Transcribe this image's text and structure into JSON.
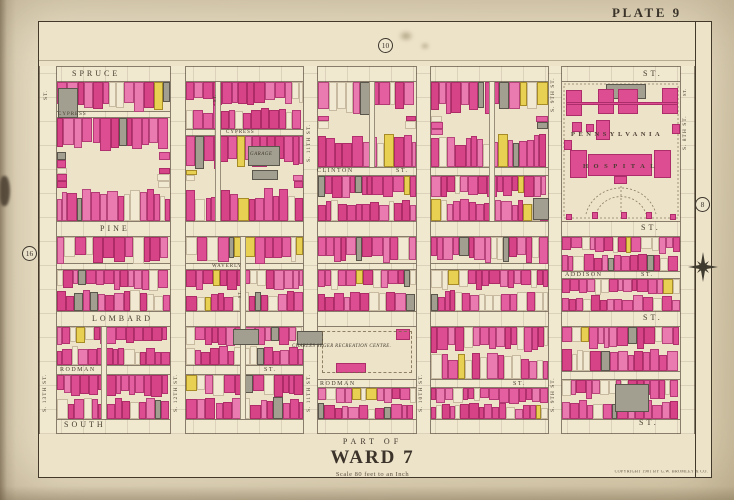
{
  "page": {
    "plate_label": "PLATE 9",
    "part_of": "PART OF",
    "ward_title": "WARD 7",
    "scale_note": "Scale 80 feet to an Inch",
    "copyright": "COPYRIGHT 1901 BY G.W. BROMLEY & CO."
  },
  "plate_refs": [
    {
      "label": "10",
      "x": 378,
      "y": 38
    },
    {
      "label": "16",
      "x": 22,
      "y": 246
    },
    {
      "label": "8",
      "x": 695,
      "y": 197
    }
  ],
  "colors": {
    "pinks": [
      "#e35f9f",
      "#dd4d92",
      "#e97bb0",
      "#d64386"
    ],
    "pink_border": "rgba(140,25,80,0.55)",
    "gray": "#a29e90",
    "gray_border": "rgba(60,55,45,0.7)",
    "yellow": "#e8d152",
    "yellow_border": "rgba(140,110,20,0.7)",
    "cream_lot": "#f2e9d2",
    "cream_border": "rgba(120,100,70,0.35)"
  },
  "streets": {
    "bands": [
      {
        "name": "spruce-st",
        "dir": "h",
        "x": 39,
        "y": 66,
        "w": 656,
        "h": 16
      },
      {
        "name": "cypress-st-w",
        "dir": "h",
        "x": 39,
        "y": 111,
        "w": 131,
        "h": 7
      },
      {
        "name": "cypress-st-e",
        "dir": "h",
        "x": 170,
        "y": 129,
        "w": 133,
        "h": 7
      },
      {
        "name": "clinton-st",
        "dir": "h",
        "x": 303,
        "y": 167,
        "w": 245,
        "h": 9
      },
      {
        "name": "pine-st",
        "dir": "h",
        "x": 39,
        "y": 221,
        "w": 656,
        "h": 16
      },
      {
        "name": "waverly-st",
        "dir": "h",
        "x": 39,
        "y": 263,
        "w": 509,
        "h": 7
      },
      {
        "name": "addison-st",
        "dir": "h",
        "x": 548,
        "y": 271,
        "w": 147,
        "h": 8
      },
      {
        "name": "lombard-st",
        "dir": "h",
        "x": 39,
        "y": 311,
        "w": 656,
        "h": 16
      },
      {
        "name": "rodman-st-w",
        "dir": "h",
        "x": 39,
        "y": 365,
        "w": 264,
        "h": 10
      },
      {
        "name": "rodman-st-c",
        "dir": "h",
        "x": 303,
        "y": 379,
        "w": 245,
        "h": 9
      },
      {
        "name": "rodman-st-e",
        "dir": "h",
        "x": 548,
        "y": 371,
        "w": 147,
        "h": 9
      },
      {
        "name": "south-st",
        "dir": "h",
        "x": 39,
        "y": 419,
        "w": 656,
        "h": 15
      },
      {
        "name": "s-13th-st",
        "dir": "v",
        "x": 39,
        "y": 66,
        "w": 18,
        "h": 368
      },
      {
        "name": "s-12th-st",
        "dir": "v",
        "x": 170,
        "y": 66,
        "w": 16,
        "h": 368
      },
      {
        "name": "s-11th-st",
        "dir": "v",
        "x": 303,
        "y": 66,
        "w": 15,
        "h": 368
      },
      {
        "name": "s-10th-st",
        "dir": "v",
        "x": 416,
        "y": 66,
        "w": 15,
        "h": 368
      },
      {
        "name": "s-9th-st",
        "dir": "v",
        "x": 548,
        "y": 66,
        "w": 14,
        "h": 368
      },
      {
        "name": "s-8th-st",
        "dir": "v",
        "x": 680,
        "y": 66,
        "w": 15,
        "h": 368
      }
    ],
    "labels": [
      {
        "name": "spruce",
        "cls": "major",
        "x": 72,
        "y": 70,
        "text": "SPRUCE"
      },
      {
        "name": "spruce-st",
        "cls": "major",
        "x": 643,
        "y": 70,
        "text": "ST."
      },
      {
        "name": "cypress-w",
        "cls": "tiny",
        "x": 58,
        "y": 111.5,
        "text": "CYPRESS"
      },
      {
        "name": "cypress-e",
        "cls": "tiny",
        "x": 226,
        "y": 129.5,
        "text": "CYPRESS"
      },
      {
        "name": "clinton",
        "cls": "minor",
        "x": 317,
        "y": 168,
        "text": "CLINTON"
      },
      {
        "name": "clinton-st",
        "cls": "minor",
        "x": 396,
        "y": 168,
        "text": "ST."
      },
      {
        "name": "pine",
        "cls": "major",
        "x": 100,
        "y": 225,
        "text": "PINE"
      },
      {
        "name": "pine-st",
        "cls": "major",
        "x": 641,
        "y": 224,
        "text": "ST."
      },
      {
        "name": "waverly",
        "cls": "tiny",
        "x": 212,
        "y": 263.5,
        "text": "WAVERLY"
      },
      {
        "name": "addison",
        "cls": "minor",
        "x": 565,
        "y": 271.5,
        "text": "ADDISON"
      },
      {
        "name": "addison-st",
        "cls": "minor",
        "x": 641,
        "y": 271.5,
        "text": "ST."
      },
      {
        "name": "lombard",
        "cls": "major",
        "x": 92,
        "y": 315,
        "text": "LOMBARD"
      },
      {
        "name": "lombard-st",
        "cls": "major",
        "x": 643,
        "y": 314,
        "text": "ST."
      },
      {
        "name": "rodman-w",
        "cls": "minor",
        "x": 60,
        "y": 366.5,
        "text": "RODMAN"
      },
      {
        "name": "rodman-w-st",
        "cls": "minor",
        "x": 264,
        "y": 366.5,
        "text": "ST."
      },
      {
        "name": "rodman-c",
        "cls": "minor",
        "x": 320,
        "y": 381,
        "text": "RODMAN"
      },
      {
        "name": "rodman-c-st",
        "cls": "minor",
        "x": 513,
        "y": 380.5,
        "text": "ST."
      },
      {
        "name": "south",
        "cls": "major",
        "x": 64,
        "y": 421,
        "text": "SOUTH"
      },
      {
        "name": "south-st",
        "cls": "major",
        "x": 639,
        "y": 419,
        "text": "ST."
      },
      {
        "name": "s-13th",
        "cls": "vert",
        "x": 43,
        "y": 412,
        "text": "S. 13TH ST."
      },
      {
        "name": "s-12th",
        "cls": "vert",
        "x": 174,
        "y": 412,
        "text": "S. 12TH ST."
      },
      {
        "name": "s-11th-s",
        "cls": "vert",
        "x": 307,
        "y": 412,
        "text": "S. 11TH ST."
      },
      {
        "name": "s-10th-s",
        "cls": "vert",
        "x": 419,
        "y": 412,
        "text": "S. 10TH ST."
      },
      {
        "name": "s-9th-s",
        "cls": "vert",
        "x": 551,
        "y": 412,
        "text": "S. 9TH ST."
      },
      {
        "name": "s-11th-n",
        "cls": "vert",
        "x": 307,
        "y": 162,
        "text": "S. 11TH ST."
      },
      {
        "name": "s-9th-n",
        "cls": "vert",
        "x": 551,
        "y": 112,
        "text": "S. 9TH ST."
      },
      {
        "name": "s-8th",
        "cls": "vert",
        "x": 683,
        "y": 150,
        "text": "S. 8TH ST."
      },
      {
        "name": "st-corner-nw",
        "cls": "vert",
        "x": 44,
        "y": 100,
        "text": "ST."
      },
      {
        "name": "st-8th-n",
        "cls": "vtiny",
        "x": 683,
        "y": 96,
        "text": "ST."
      },
      {
        "name": "alley-st-1",
        "cls": "vtiny",
        "x": 213,
        "y": 102,
        "text": "ST."
      },
      {
        "name": "alley-st-2",
        "cls": "vtiny",
        "x": 238,
        "y": 298,
        "text": "ST."
      }
    ]
  },
  "alleys": [
    {
      "x": 215,
      "y": 82,
      "w": 6,
      "h": 139
    },
    {
      "x": 240,
      "y": 237,
      "w": 6,
      "h": 182
    },
    {
      "x": 369,
      "y": 82,
      "w": 6,
      "h": 85
    },
    {
      "x": 489,
      "y": 82,
      "w": 6,
      "h": 139
    },
    {
      "x": 101,
      "y": 327,
      "w": 6,
      "h": 92
    }
  ],
  "blocks": [
    {
      "x": 57,
      "y": 82,
      "w": 113,
      "h": 29
    },
    {
      "x": 186,
      "y": 82,
      "w": 117,
      "h": 47
    },
    {
      "x": 318,
      "y": 82,
      "w": 98,
      "h": 85
    },
    {
      "x": 431,
      "y": 82,
      "w": 117,
      "h": 85
    },
    {
      "x": 57,
      "y": 118,
      "w": 113,
      "h": 103
    },
    {
      "x": 186,
      "y": 136,
      "w": 117,
      "h": 85
    },
    {
      "x": 318,
      "y": 176,
      "w": 98,
      "h": 45
    },
    {
      "x": 431,
      "y": 176,
      "w": 117,
      "h": 45
    },
    {
      "x": 57,
      "y": 237,
      "w": 113,
      "h": 26
    },
    {
      "x": 186,
      "y": 237,
      "w": 117,
      "h": 26
    },
    {
      "x": 318,
      "y": 237,
      "w": 98,
      "h": 26
    },
    {
      "x": 431,
      "y": 237,
      "w": 117,
      "h": 26
    },
    {
      "x": 562,
      "y": 237,
      "w": 118,
      "h": 34
    },
    {
      "x": 57,
      "y": 270,
      "w": 113,
      "h": 41
    },
    {
      "x": 186,
      "y": 270,
      "w": 117,
      "h": 41
    },
    {
      "x": 318,
      "y": 270,
      "w": 98,
      "h": 41
    },
    {
      "x": 431,
      "y": 270,
      "w": 117,
      "h": 41
    },
    {
      "x": 562,
      "y": 279,
      "w": 118,
      "h": 32
    },
    {
      "x": 57,
      "y": 327,
      "w": 113,
      "h": 38
    },
    {
      "x": 186,
      "y": 327,
      "w": 117,
      "h": 38
    },
    {
      "x": 431,
      "y": 327,
      "w": 117,
      "h": 52
    },
    {
      "x": 562,
      "y": 327,
      "w": 118,
      "h": 44
    },
    {
      "x": 57,
      "y": 375,
      "w": 113,
      "h": 44
    },
    {
      "x": 186,
      "y": 375,
      "w": 117,
      "h": 44
    },
    {
      "x": 318,
      "y": 388,
      "w": 98,
      "h": 31
    },
    {
      "x": 431,
      "y": 388,
      "w": 117,
      "h": 31
    },
    {
      "x": 562,
      "y": 380,
      "w": 118,
      "h": 39
    }
  ],
  "special_buildings": [
    {
      "type": "gray",
      "x": 58,
      "y": 88,
      "w": 20,
      "h": 30
    },
    {
      "type": "gray",
      "x": 248,
      "y": 146,
      "w": 32,
      "h": 20
    },
    {
      "type": "gray",
      "x": 252,
      "y": 170,
      "w": 26,
      "h": 10
    },
    {
      "type": "gray",
      "x": 233,
      "y": 329,
      "w": 26,
      "h": 16
    },
    {
      "type": "gray",
      "x": 297,
      "y": 331,
      "w": 26,
      "h": 14
    },
    {
      "type": "gray",
      "x": 533,
      "y": 198,
      "w": 16,
      "h": 22
    },
    {
      "type": "gray",
      "x": 615,
      "y": 384,
      "w": 34,
      "h": 28
    },
    {
      "type": "pink",
      "x": 336,
      "y": 363,
      "w": 30,
      "h": 10
    },
    {
      "type": "pink",
      "x": 396,
      "y": 329,
      "w": 14,
      "h": 11
    }
  ],
  "landmark_labels": [
    {
      "name": "garage-label",
      "cls": "it5",
      "x": 250,
      "y": 152,
      "text": "GARAGE"
    }
  ],
  "hospital": {
    "x": 562,
    "y": 82,
    "w": 118,
    "h": 139,
    "line1": "PENNSYLVANIA",
    "line2": "HOSPITAL",
    "line1_pos": {
      "x": 9,
      "y": 50
    },
    "line2_pos": {
      "x": 21,
      "y": 82
    },
    "buildings": [
      {
        "type": "gray",
        "x": 44,
        "y": 2,
        "w": 40,
        "h": 15
      },
      {
        "type": "pink",
        "x": 4,
        "y": 8,
        "w": 16,
        "h": 26
      },
      {
        "type": "pink",
        "x": 36,
        "y": 7,
        "w": 16,
        "h": 25
      },
      {
        "type": "pink",
        "x": 56,
        "y": 7,
        "w": 20,
        "h": 25
      },
      {
        "type": "pink",
        "x": 100,
        "y": 6,
        "w": 16,
        "h": 26
      },
      {
        "type": "pink",
        "x": 4,
        "y": 20,
        "w": 112,
        "h": 3
      },
      {
        "type": "pink",
        "x": 10,
        "y": 40,
        "w": 10,
        "h": 10
      },
      {
        "type": "pink",
        "x": 24,
        "y": 42,
        "w": 8,
        "h": 8
      },
      {
        "type": "pink",
        "x": 34,
        "y": 38,
        "w": 14,
        "h": 20
      },
      {
        "type": "pink",
        "x": 110,
        "y": 42,
        "w": 8,
        "h": 10
      },
      {
        "type": "pink",
        "x": 2,
        "y": 58,
        "w": 8,
        "h": 10
      },
      {
        "type": "pink",
        "x": 8,
        "y": 68,
        "w": 17,
        "h": 28
      },
      {
        "type": "pink",
        "x": 92,
        "y": 68,
        "w": 17,
        "h": 28
      },
      {
        "type": "pink",
        "x": 26,
        "y": 72,
        "w": 64,
        "h": 22
      },
      {
        "type": "pink",
        "x": 52,
        "y": 94,
        "w": 13,
        "h": 8
      },
      {
        "type": "pink",
        "x": 30,
        "y": 130,
        "w": 6,
        "h": 7
      },
      {
        "type": "pink",
        "x": 59,
        "y": 130,
        "w": 6,
        "h": 7
      },
      {
        "type": "pink",
        "x": 84,
        "y": 130,
        "w": 6,
        "h": 7
      },
      {
        "type": "pink",
        "x": 4,
        "y": 132,
        "w": 6,
        "h": 6
      },
      {
        "type": "pink",
        "x": 108,
        "y": 132,
        "w": 6,
        "h": 6
      }
    ]
  },
  "recreation": {
    "x": 318,
    "y": 327,
    "w": 98,
    "h": 52,
    "label": "CHARLES SEGER RECREATION CENTRE.",
    "label_pos": {
      "x": 292,
      "y": 345
    }
  }
}
